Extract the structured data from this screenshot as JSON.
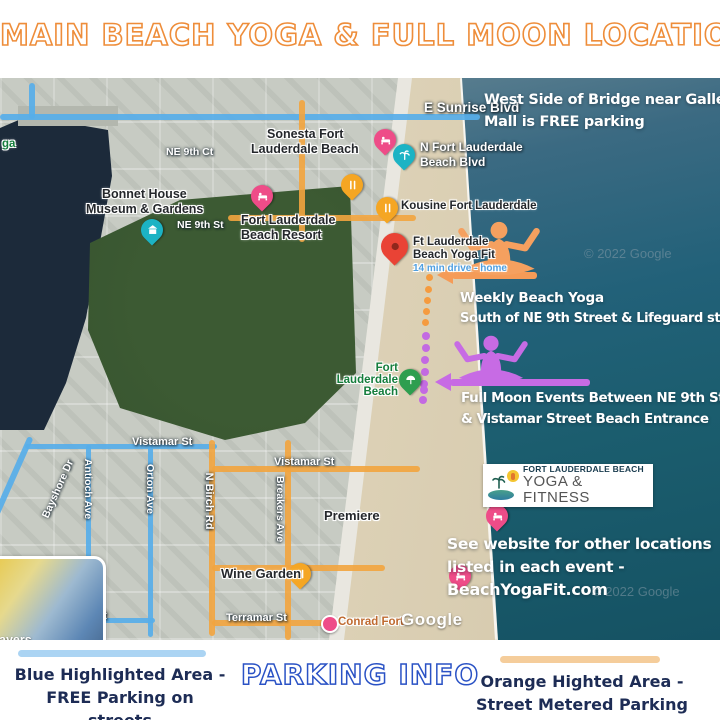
{
  "title": "MAIN BEACH YOGA & FULL MOON LOCATION",
  "colors": {
    "title_outline": "#ee8d3a",
    "parking_outline": "#2a52c5",
    "footer_text": "#1d2c55",
    "blue_street": "#57aee9",
    "orange_street": "#f2a43e",
    "purple_route": "#c36ae2",
    "orange_route": "#f59b3f",
    "red_pin": "#e94335",
    "pink_pin": "#ee4c88",
    "teal_pin": "#1cb3c4",
    "orange_pin": "#f5a623",
    "green_pin": "#2e9e4f"
  },
  "map": {
    "streets": {
      "sunrise": "E Sunrise Blvd",
      "ne9ct": "NE 9th Ct",
      "ne9st": "NE 9th St",
      "nflb1": "N Fort Lauderdale",
      "nflb2": "Beach Blvd",
      "vistamar": "Vistamar St",
      "terramar": "Terramar St",
      "bayshore": "Bayshore Dr",
      "antioch": "Antioch Ave",
      "orton": "Orton Ave",
      "birch": "N Birch Rd",
      "breakers": "Breakers Ave"
    },
    "pois": {
      "sonesta1": "Sonesta Fort",
      "sonesta2": "Lauderdale Beach",
      "bonnet1": "Bonnet House",
      "bonnet2": "Museum & Gardens",
      "resort1": "Fort Lauderdale",
      "resort2": "Beach Resort",
      "kousine": "Kousine Fort Lauderdale",
      "yogafit1": "Ft Lauderdale",
      "yogafit2": "Beach Yoga Fit",
      "drive": "14 min drive - home",
      "beach1": "Fort",
      "beach2": "Lauderdale",
      "beach3": "Beach",
      "premiere": "Premiere",
      "wine": "Wine Garden",
      "conrad": "Conrad Fort",
      "park_fragment": "ga"
    },
    "notes": {
      "west1": "West Side of Bridge near Galleria",
      "west2": "Mall is FREE parking",
      "weekly1": "Weekly Beach Yoga",
      "weekly2": "South of NE 9th Street & Lifeguard stand #13",
      "moon1": "Full Moon Events Between NE 9th Street",
      "moon2": "& Vistamar Street Beach Entrance",
      "site1": "See  website for other locations",
      "site2": "listed in each event  -",
      "site3": "BeachYogaFit.com"
    },
    "logo": {
      "name": "FORT LAUDERDALE BEACH",
      "sub": "YOGA & FITNESS"
    },
    "watermark": "© 2022 Google",
    "google": "Google",
    "layers": "ayers"
  },
  "footer": {
    "blue1": "Blue Highlighted Area -",
    "blue2": "FREE Parking on streets",
    "center": "PARKING INFO",
    "orange1": "Orange Highted Area -",
    "orange2": "Street Metered Parking"
  }
}
